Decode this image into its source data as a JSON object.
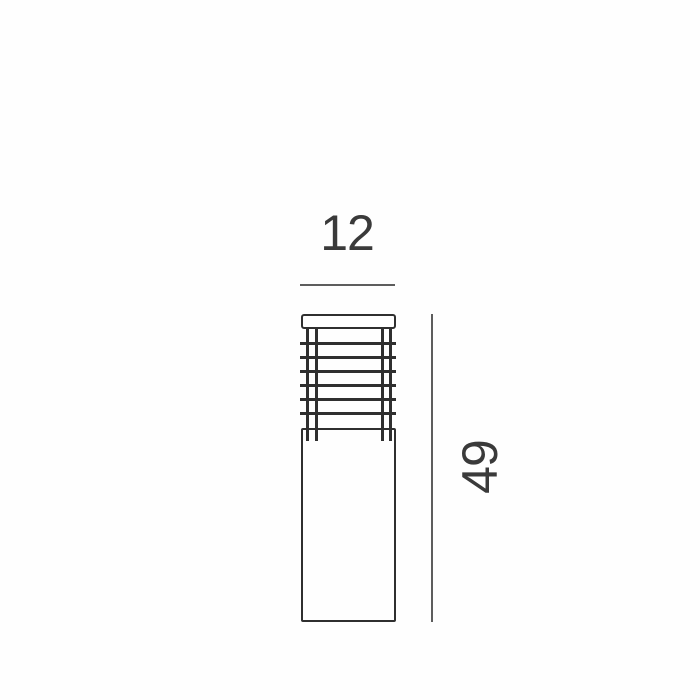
{
  "diagram": {
    "width_dimension": {
      "label": "12"
    },
    "height_dimension": {
      "label": "49"
    },
    "grille": {
      "bar_count": 6,
      "post_count": 4,
      "bar_start_top": 30,
      "bar_spacing": 14
    }
  },
  "colors": {
    "background": "#fefefe",
    "outline": "#2f2f2f",
    "dimension_line": "#5d5d5d",
    "label_text": "#3a3a3a"
  }
}
